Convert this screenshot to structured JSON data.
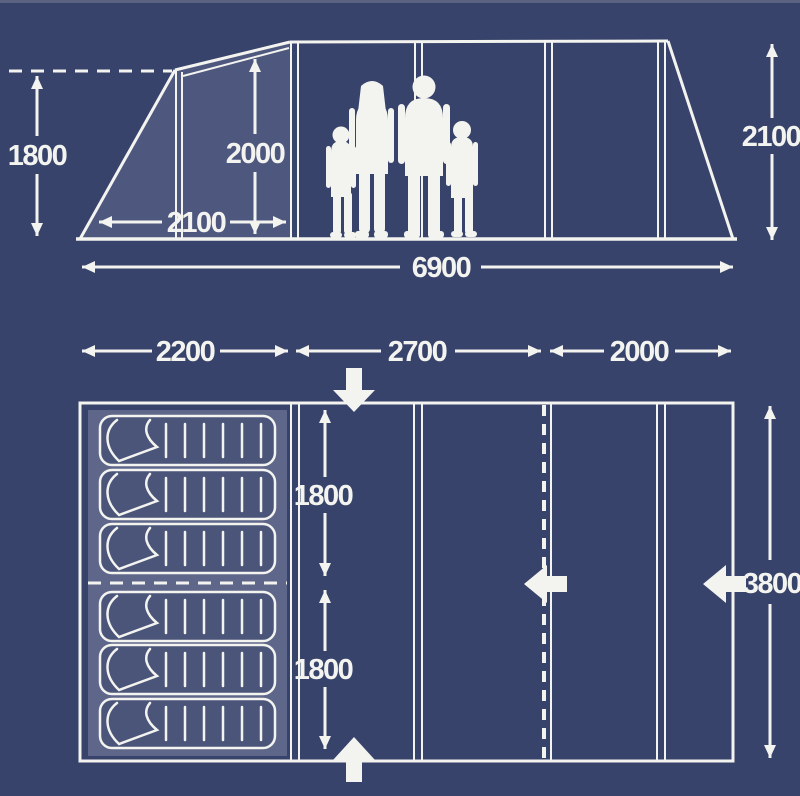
{
  "colors": {
    "background": "#37436a",
    "top_edge": "#5b6281",
    "line": "#f3f3f0",
    "panel_shade": "#4e587e",
    "bedroom_fill": "#5e668a",
    "bag_fill": "#4b5579"
  },
  "side_view": {
    "dims": {
      "front_height": "1800",
      "living_height": "2000",
      "porch_length": "2100",
      "rear_height": "2100",
      "total_length": "6900"
    }
  },
  "floor_plan": {
    "dims": {
      "bedroom_width": "2200",
      "living_width": "2700",
      "porch_width": "2000",
      "bedroom_depth_front": "1800",
      "bedroom_depth_rear": "1800",
      "total_depth": "3800"
    },
    "sleeping_bag_count": 6,
    "entrance_icons": [
      "arrow-down",
      "arrow-up",
      "arrow-left",
      "arrow-left"
    ]
  }
}
